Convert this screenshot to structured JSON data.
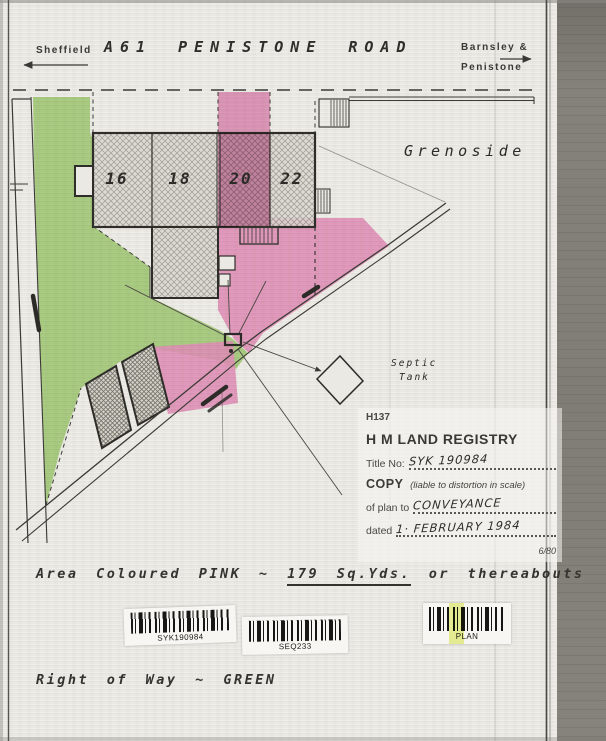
{
  "header": {
    "left_destination": "Sheffield",
    "route_number": "A61",
    "road_name_word1": "PENISTONE",
    "road_name_word2": "ROAD",
    "right_destination_line1": "Barnsley &",
    "right_destination_line2": "Penistone"
  },
  "map": {
    "place_label": "Grenoside",
    "house_numbers": [
      "16",
      "18",
      "20",
      "22"
    ],
    "septic_tank_label_line1": "Septic",
    "septic_tank_label_line2": "Tank"
  },
  "stamp": {
    "form_code": "H137",
    "registry_title": "H M LAND REGISTRY",
    "title_no_label": "Title No:",
    "title_no_value": "SYK 190984",
    "copy_word": "COPY",
    "copy_note": "(liable to distortion in scale)",
    "of_plan_label": "of plan to",
    "of_plan_value": "CONVEYANCE",
    "dated_label": "dated",
    "dated_value": "1· FEBRUARY 1984",
    "print_code": "6/80"
  },
  "annotations": {
    "pink_area_prefix": "Area Coloured PINK ~",
    "pink_area_value": "179 Sq.Yds.",
    "pink_area_suffix": "or thereabouts",
    "right_of_way": "Right of Way ~ GREEN"
  },
  "barcodes": [
    {
      "label": "SYK190984"
    },
    {
      "label": "SEQ233"
    },
    {
      "label": "PLAN"
    }
  ],
  "colors": {
    "pink_area": "#f09aca",
    "green_area": "#aed884",
    "building_fill": "#dbd8d1",
    "paper": "#ebe9e3",
    "ink": "#2e2d29",
    "highlight_yellow": "#e3ee6d"
  }
}
